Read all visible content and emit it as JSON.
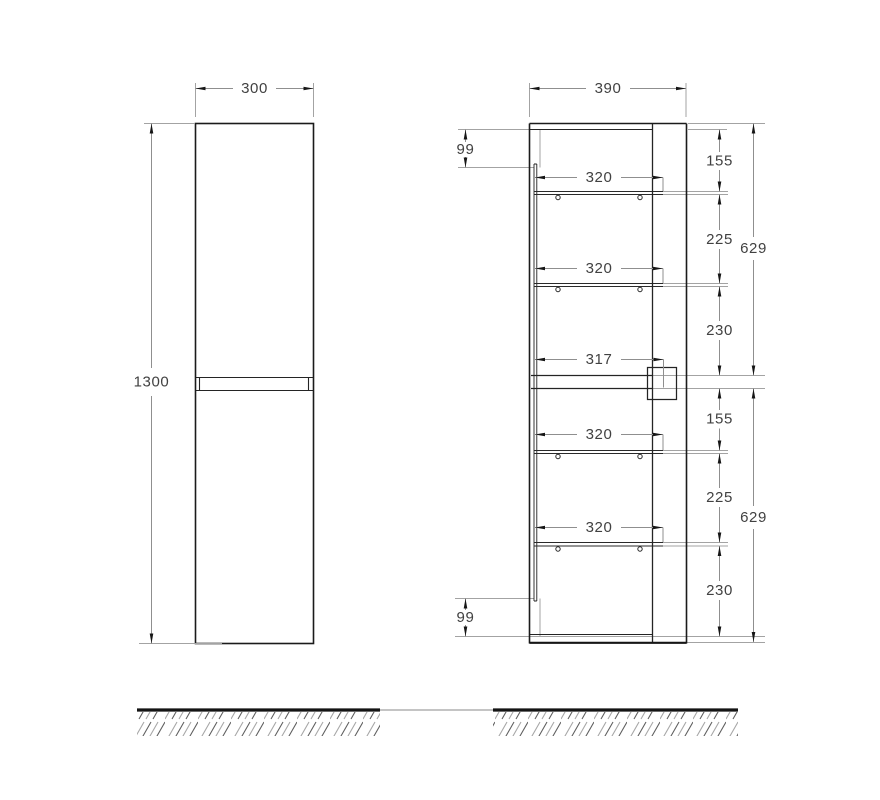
{
  "front_view": {
    "width": "300",
    "height": "1300"
  },
  "side_view": {
    "depth": "390",
    "back_panel_top_offset": "99",
    "back_panel_bottom_offset": "99",
    "shelf_depths": [
      "320",
      "320",
      "317",
      "320",
      "320"
    ],
    "inner_heights": [
      "155",
      "225",
      "230",
      "155",
      "225",
      "230"
    ],
    "half_heights": [
      "629",
      "629"
    ]
  }
}
